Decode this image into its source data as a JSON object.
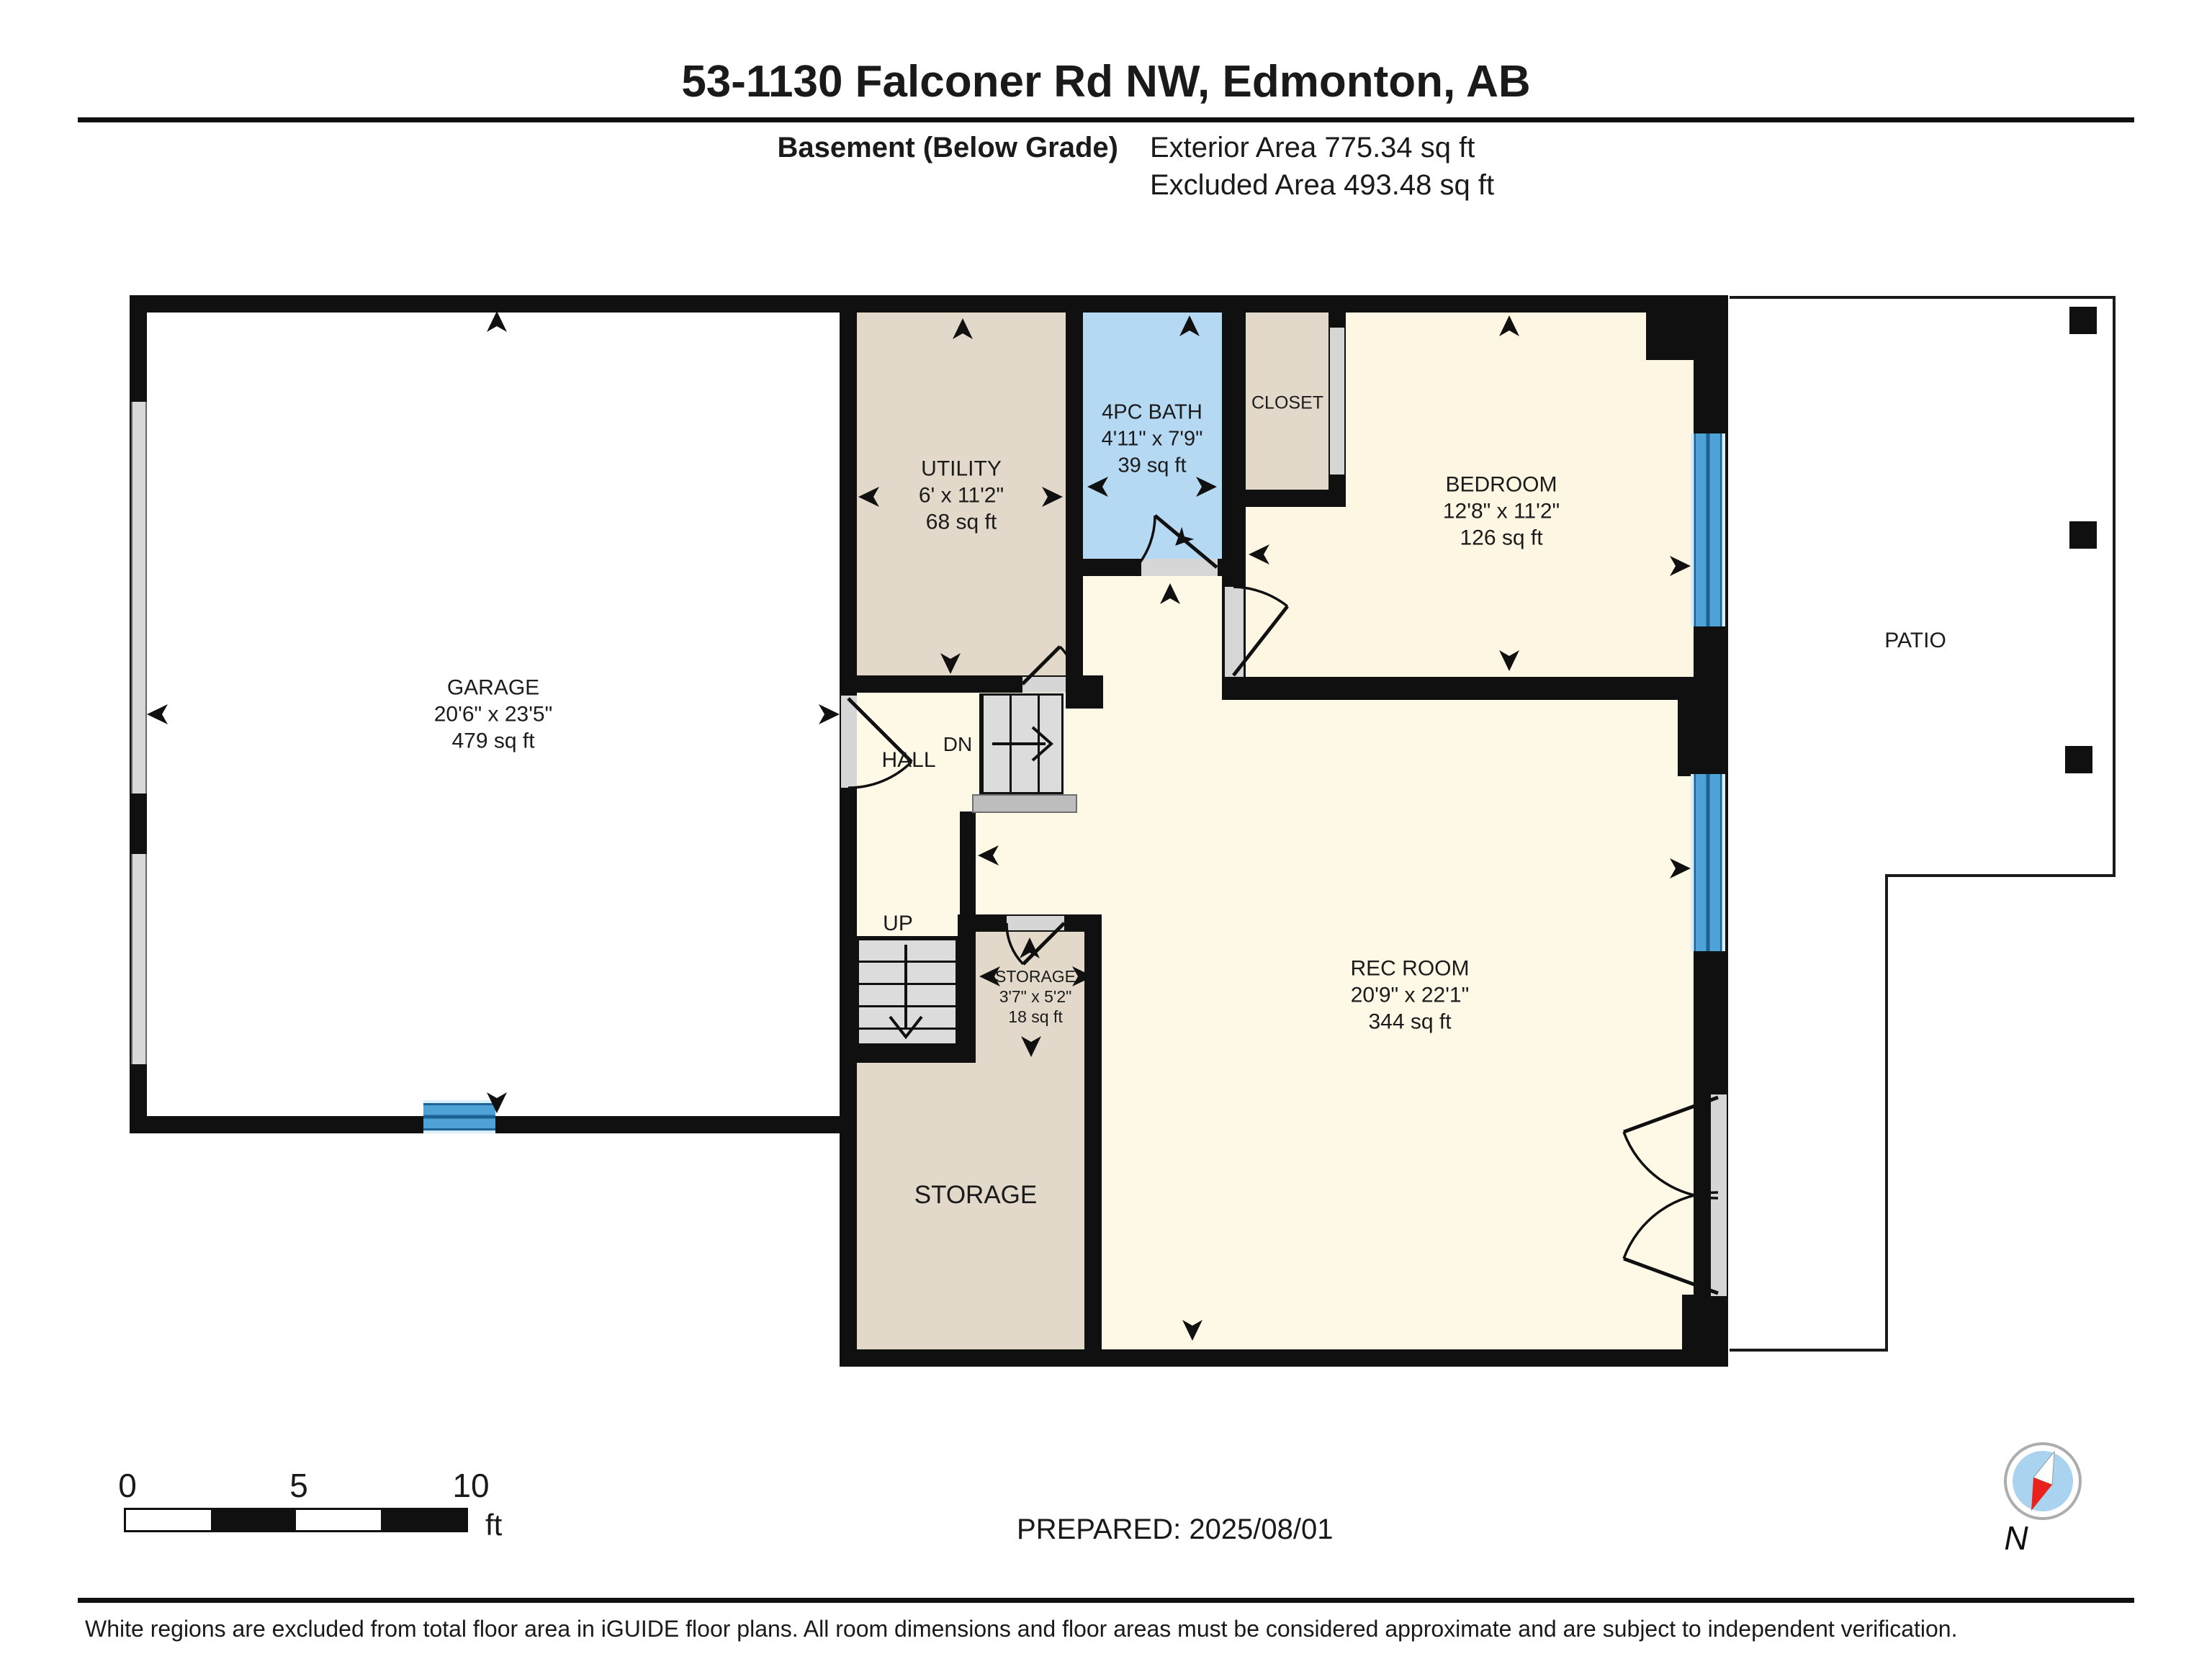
{
  "header": {
    "title": "53-1130 Falconer Rd NW, Edmonton, AB",
    "floor_label": "Basement (Below Grade)",
    "exterior_area": "Exterior Area 775.34 sq ft",
    "excluded_area": "Excluded Area 493.48 sq ft"
  },
  "rooms": {
    "garage": {
      "name": "GARAGE",
      "dims": "20'6\" x 23'5\"",
      "area": "479 sq ft"
    },
    "utility": {
      "name": "UTILITY",
      "dims": "6' x 11'2\"",
      "area": "68 sq ft"
    },
    "bath": {
      "name": "4PC BATH",
      "dims": "4'11\" x 7'9\"",
      "area": "39 sq ft"
    },
    "closet": {
      "name": "CLOSET"
    },
    "bedroom": {
      "name": "BEDROOM",
      "dims": "12'8\" x 11'2\"",
      "area": "126 sq ft"
    },
    "patio": {
      "name": "PATIO"
    },
    "hall": {
      "name": "HALL"
    },
    "rec_room": {
      "name": "REC ROOM",
      "dims": "20'9\" x 22'1\"",
      "area": "344 sq ft"
    },
    "storage_small": {
      "name": "STORAGE",
      "dims": "3'7\" x 5'2\"",
      "area": "18 sq ft"
    },
    "storage_large": {
      "name": "STORAGE"
    }
  },
  "stairs": {
    "dn_label": "DN",
    "up_label": "UP"
  },
  "scale_bar": {
    "tick_0": "0",
    "tick_5": "5",
    "tick_10": "10",
    "unit": "ft"
  },
  "footer": {
    "prepared": "PREPARED: 2025/08/01",
    "disclaimer": "White regions are excluded from total floor area in iGUIDE floor plans. All room dimensions and floor areas must be considered approximate and are subject to independent verification."
  },
  "compass": {
    "north_label": "N"
  },
  "colors": {
    "wall": "#101010",
    "room_cream": "#fdf6e2",
    "room_tan": "#e2d9ca",
    "bath_blue": "#b5d9f3",
    "window_blue": "#4fa2d5",
    "excluded_white": "#ffffff",
    "compass_red": "#e8231e",
    "compass_blue": "#a9d3ee"
  }
}
